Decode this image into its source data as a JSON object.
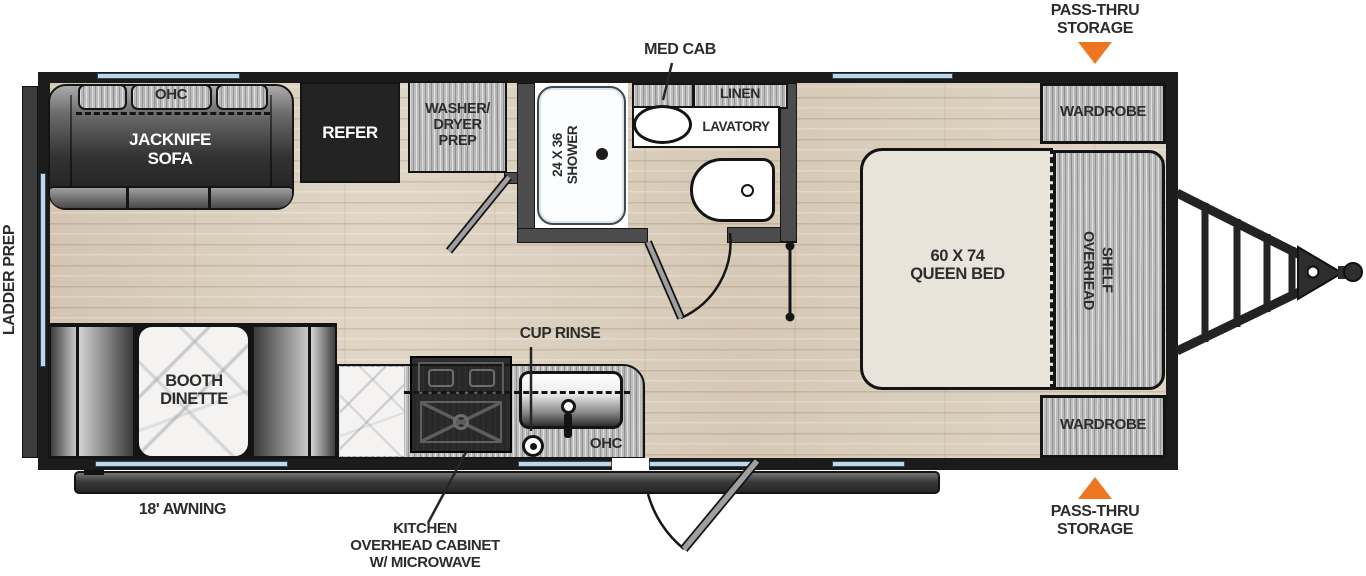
{
  "colors": {
    "accent_orange": "#EE7623",
    "wall_black": "#1B1B1B",
    "window_blue": "#BCD8EB",
    "floor_wood": "#DDD2C1"
  },
  "callouts": {
    "ladder_prep": "LADDER PREP",
    "pass_thru_top": "PASS-THRU\nSTORAGE",
    "pass_thru_bottom": "PASS-THRU\nSTORAGE",
    "med_cab": "MED CAB",
    "cup_rinse": "CUP RINSE",
    "awning": "18' AWNING",
    "kitchen_overhead_cabinet": "KITCHEN\nOVERHEAD CABINET\nW/ MICROWAVE"
  },
  "fixtures": {
    "sofa_ohc": "OHC",
    "jacknife_sofa": "JACKNIFE\nSOFA",
    "refer": "REFER",
    "washer_dryer_prep": "WASHER/\nDRYER\nPREP",
    "shower": "24 X 36\nSHOWER",
    "linen": "LINEN",
    "lavatory": "LAVATORY",
    "wardrobe_top": "WARDROBE",
    "wardrobe_bottom": "WARDROBE",
    "queen_bed": "60 X 74\nQUEEN BED",
    "overhead_shelf": "OVERHEAD\nSHELF",
    "booth_dinette": "BOOTH\nDINETTE",
    "kitchen_ohc": "OHC"
  }
}
